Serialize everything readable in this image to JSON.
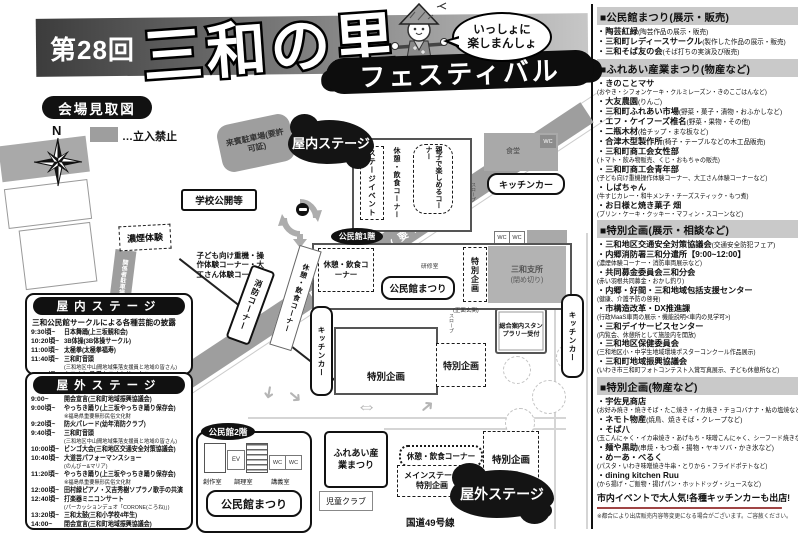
{
  "header": {
    "edition": "第28回",
    "title": "三和の里",
    "festival": "フェスティバル",
    "speech_line1": "いっしょに",
    "speech_line2": "楽しまんしょ"
  },
  "map": {
    "caption": "会場見取図",
    "north": "N",
    "legend": {
      "swatch_color": "#9e9e9e",
      "label": "…立入禁止"
    },
    "labels": {
      "staff_parking": "関係者駐車場(要許可証)",
      "guest_parking": "来賓駐車場(要許可証)",
      "school_open": "学校公開等",
      "smoke_experience": "濃煙体験",
      "kids_corner": "子ども向け重機・操作体験コーナー・大工さん体験コーナーなど",
      "indoor_stage": "屋内ステージ",
      "outdoor_stage": "屋外ステージ",
      "stage_event": "ステージイベント",
      "rest_corner": "休憩・飲食コーナー",
      "family_corner": "親子で楽しめるコーナー",
      "dining_hall": "食堂",
      "kitchen_car": "キッチンカー",
      "wc": "WC",
      "ev": "EV",
      "slope": "スロープ",
      "kominkan_1f": "公民館1階",
      "kominkan_2f": "公民館2階",
      "kominkan_matsuri": "公民館まつり",
      "training_room": "研修室",
      "craft_room": "創作室",
      "cooking_room": "調理室",
      "lecture_room": "講義室",
      "branch_office": "三和支所",
      "branch_office_note": "(閉め切り)",
      "main_entrance": "(正面玄関)",
      "special_plan": "特別企画",
      "info_desk": "総合案内スタンプラリー受付",
      "fire_corner": "消防コーナー",
      "fureai_industry": "ふれあい産業まつり",
      "children_club": "児童クラブ",
      "main_stage": "メインステージ特別企画",
      "route_49": "国道49号線"
    }
  },
  "indoor_stage": {
    "title": "屋内ステージ",
    "subtitle": "三和公民館サークルによる各種芸能の披露",
    "rows": [
      {
        "time": "9:30頃~",
        "event": "日本舞踊(上三坂観和会)"
      },
      {
        "time": "10:20頃~",
        "event": "3B体操(3B体操サークル)"
      },
      {
        "time": "11:00頃~",
        "event": "太極拳(太極拳福寿)"
      },
      {
        "time": "11:40頃~",
        "event": "三和町音頭",
        "note": "(三和地区中山間地域集落支援員と地域の皆さん)"
      },
      {
        "time": "12:00頃~",
        "event": "カラオケ(歌愛カラオケサークル)"
      }
    ]
  },
  "outdoor_stage": {
    "title": "屋外ステージ",
    "rows": [
      {
        "time": "9:00~",
        "event": "開会宣言(三和町地域振興協議会)"
      },
      {
        "time": "9:00頃~",
        "event": "やっちき踊り(上三坂やっちき踊り保存会)",
        "note": "※福島県重要無形民俗文化財"
      },
      {
        "time": "9:20頃~",
        "event": "防火パレード(幼年消防クラブ)"
      },
      {
        "time": "9:40頃~",
        "event": "三和町音頭",
        "note": "(三和地区中山間地域集落支援員と地域の皆さん)"
      },
      {
        "time": "10:00頃~",
        "event": "ビンゴ大会(三和地区交通安全対策協議会)"
      },
      {
        "time": "10:40頃~",
        "event": "大道芸パフォーマンスショー",
        "note": "(のんびー&マリア)"
      },
      {
        "time": "11:20頃~",
        "event": "やっちき踊り(上三坂やっちき踊り保存会)",
        "note": "※福島県重要無形民俗文化財"
      },
      {
        "time": "12:00頃~",
        "event": "田村緑ピアノ・又吉秀樹ソプラノ歌手の共演"
      },
      {
        "time": "12:40頃~",
        "event": "打楽器ミニコンサート",
        "note": "(パーカッションデュオ「CORONE(ころね)」)"
      },
      {
        "time": "13:20頃~",
        "event": "三和太鼓(三和小学校4年生)"
      },
      {
        "time": "14:00~",
        "event": "閉会宣言(三和町地域振興協議会)"
      }
    ]
  },
  "right_column": {
    "sections": [
      {
        "title": "■公民館まつり(展示・販売)",
        "lines": [
          {
            "type": "item",
            "text": "陶芸紅緑",
            "note": "(陶芸作品の展示・販売)"
          },
          {
            "type": "item",
            "text": "三和町レディースサークル",
            "note": "(製作した作品の展示・販売)"
          },
          {
            "type": "item",
            "text": "三和そば友の会",
            "note": "(そば打ちの実演及び販売)"
          }
        ]
      },
      {
        "title": "■ふれあい産業まつり(物産など)",
        "lines": [
          {
            "type": "item",
            "text": "きのことマサ"
          },
          {
            "type": "note",
            "text": "(おやき・シフォンケーキ・クルミレーズン・きのこごはんなど)"
          },
          {
            "type": "item",
            "text": "大友農園",
            "note": "(りんご)"
          },
          {
            "type": "item",
            "text": "三和町ふれあい市場",
            "note": "(野菜・菓子・漬物・おふかしなど)"
          },
          {
            "type": "item",
            "text": "エフ・ケイフーズ椎名",
            "note": "(野菜・果物・その他)"
          },
          {
            "type": "item",
            "text": "二瓶木材",
            "note": "(桧チップ・まな板など)"
          },
          {
            "type": "item",
            "text": "合津木型製作所",
            "note": "(椅子・テーブルなどの木工品販売)"
          },
          {
            "type": "item",
            "text": "三和町商工会女性部"
          },
          {
            "type": "note",
            "text": "(トマト・飲み物販売、くじ・おもちゃの販売)"
          },
          {
            "type": "item",
            "text": "三和町商工会青年部"
          },
          {
            "type": "note",
            "text": "(子ども向け重機操作体験コーナー、大工さん体験コーナーなど)"
          },
          {
            "type": "item",
            "text": "しばちゃん"
          },
          {
            "type": "note",
            "text": "(牛すじカレー・和牛メンチ・チーズスティック・もつ煮)"
          },
          {
            "type": "item",
            "text": "お日様と焼き菓子 畑"
          },
          {
            "type": "note",
            "text": "(プリン・ケーキ・クッキー・マフィン・スコーンなど)"
          }
        ]
      },
      {
        "title": "■特別企画(展示・相談など)",
        "lines": [
          {
            "type": "item",
            "text": "三和地区交通安全対策協議会",
            "note": "(交通安全防犯フェア)"
          },
          {
            "type": "item",
            "text": "内郷消防署三和分遣所【9:00~12:00】"
          },
          {
            "type": "note",
            "text": "(濃煙体験コーナー・消防車両展示など)"
          },
          {
            "type": "item",
            "text": "共同募金委員会三和分会"
          },
          {
            "type": "note",
            "text": "(赤い羽根共同募金・おかし釣り)"
          },
          {
            "type": "item",
            "text": "内郷・好間・三和地域包括支援センター"
          },
          {
            "type": "note",
            "text": "(健康、介護予防の啓発)"
          },
          {
            "type": "item",
            "text": "市構造改革・DX推進課"
          },
          {
            "type": "note",
            "text": "(行政MaaS車両の展示・機能説明<車内の見学可>)"
          },
          {
            "type": "item",
            "text": "三和デイサービスセンター"
          },
          {
            "type": "note",
            "text": "(内覧会、休憩所として施設内を開放)"
          },
          {
            "type": "item",
            "text": "三和地区保健委員会"
          },
          {
            "type": "note",
            "text": "(三和地区小・中学生地域環境ポスターコンクール作品展示)"
          },
          {
            "type": "item",
            "text": "三和町地域振興協議会"
          },
          {
            "type": "note",
            "text": "(いわき市三和町フォトコンテスト入賞写真展示、子ども休憩所など)"
          }
        ]
      },
      {
        "title": "■特別企画(物産など)",
        "lines": [
          {
            "type": "item",
            "text": "宇佐見商店"
          },
          {
            "type": "note",
            "text": "(お好み焼き・焼きそば・たこ焼き・イカ焼き・チョコバナナ・鮎の塩焼など)"
          },
          {
            "type": "item",
            "text": "ネモト物産",
            "note": "(焼鳥、焼きそば・クレープなど)"
          },
          {
            "type": "item",
            "text": "そば八"
          },
          {
            "type": "note",
            "text": "(玉こんにゃく・イカ串焼き・あげもち・味噌こんにゃく、シーフード焼きなど)"
          },
          {
            "type": "item",
            "text": "麺や黒助",
            "note": "(串焼・もつ煮・揚物・ヤキソバ・かき氷など)"
          },
          {
            "type": "item",
            "text": "めーあ・べるく"
          },
          {
            "type": "note",
            "text": "(パスタ・いわき味噌焼き牛串・とりから・フライドポテトなど)"
          },
          {
            "type": "item",
            "text": "dining kitchen Ruu"
          },
          {
            "type": "note",
            "text": "(から揚げ・ご飯物・揚げパン・ホットドッグ・ジュースなど)"
          }
        ]
      }
    ],
    "highlight": "市内イベントで大人気!各種キッチンカーも出店!",
    "footnote": "※都合により出店販売内容等変更になる場合がございます。ご容赦ください。"
  }
}
